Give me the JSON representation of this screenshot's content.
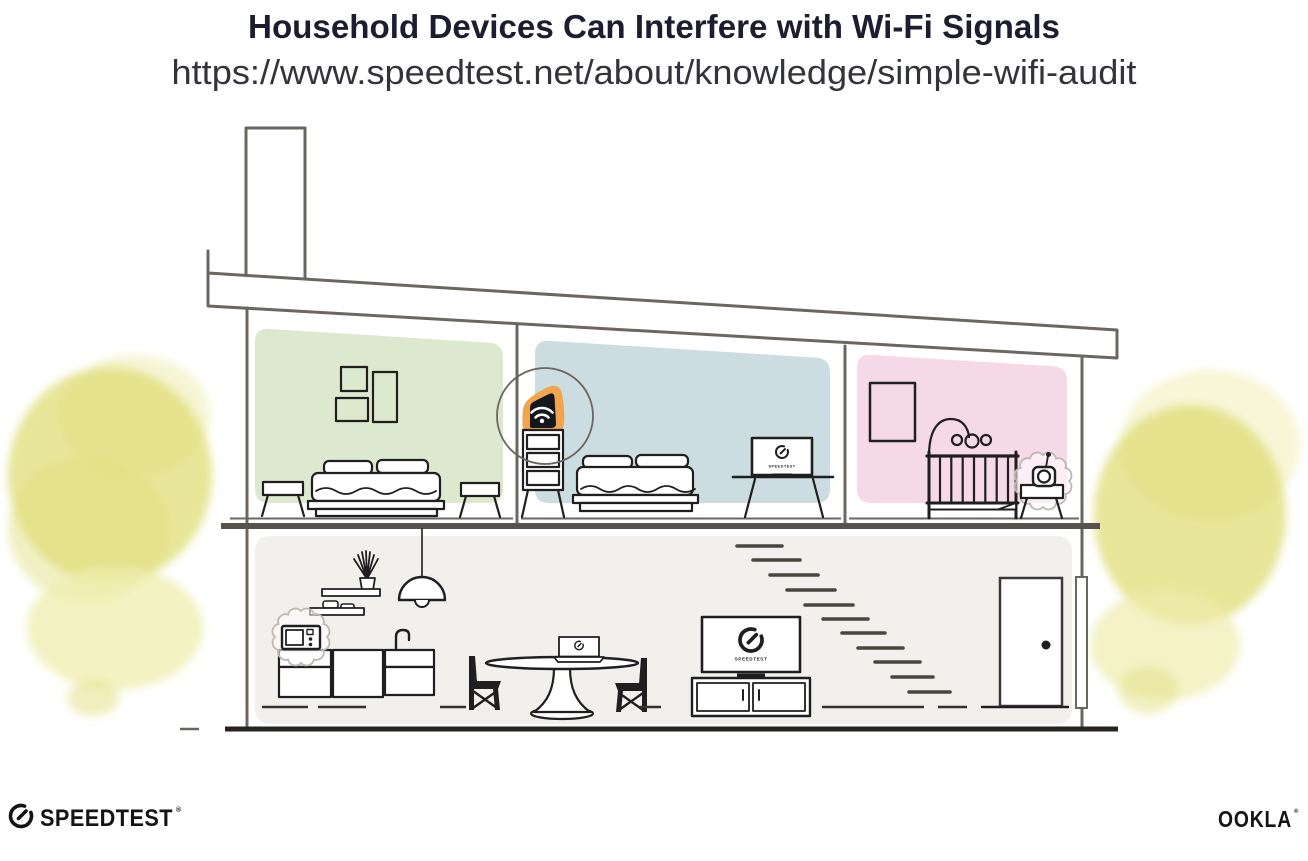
{
  "header": {
    "title": "Household Devices Can Interfere with Wi-Fi Signals",
    "url": "https://www.speedtest.net/about/knowledge/simple-wifi-audit"
  },
  "screens": {
    "tv_label": "SPEEDTEST",
    "monitor_label": "SPEEDTEST"
  },
  "footer": {
    "speedtest_wordmark": "SPEEDTEST",
    "speedtest_trademark": "®",
    "ookla_wordmark": "OOKLA",
    "ookla_trademark": "®"
  },
  "colors": {
    "title_text": "#1d1d30",
    "url_text": "#33333b",
    "logo_text": "#141414",
    "ink": "#1f1f1f",
    "line_gray": "#6b665f",
    "divider_gray": "#57524c",
    "ground_black": "#26221d",
    "stair_gray": "#4a463f",
    "green_room": "#dde9cf",
    "blue_room": "#cbdde0",
    "pink_room": "#f5d9e7",
    "floor_gray": "#f1f0ed",
    "router_orange": "#f0a44e",
    "router_black": "#15161e",
    "tree_yellow": "#e1de7d",
    "tree_yellow_light": "#efedae",
    "burst_gray": "#bdb8b0"
  }
}
